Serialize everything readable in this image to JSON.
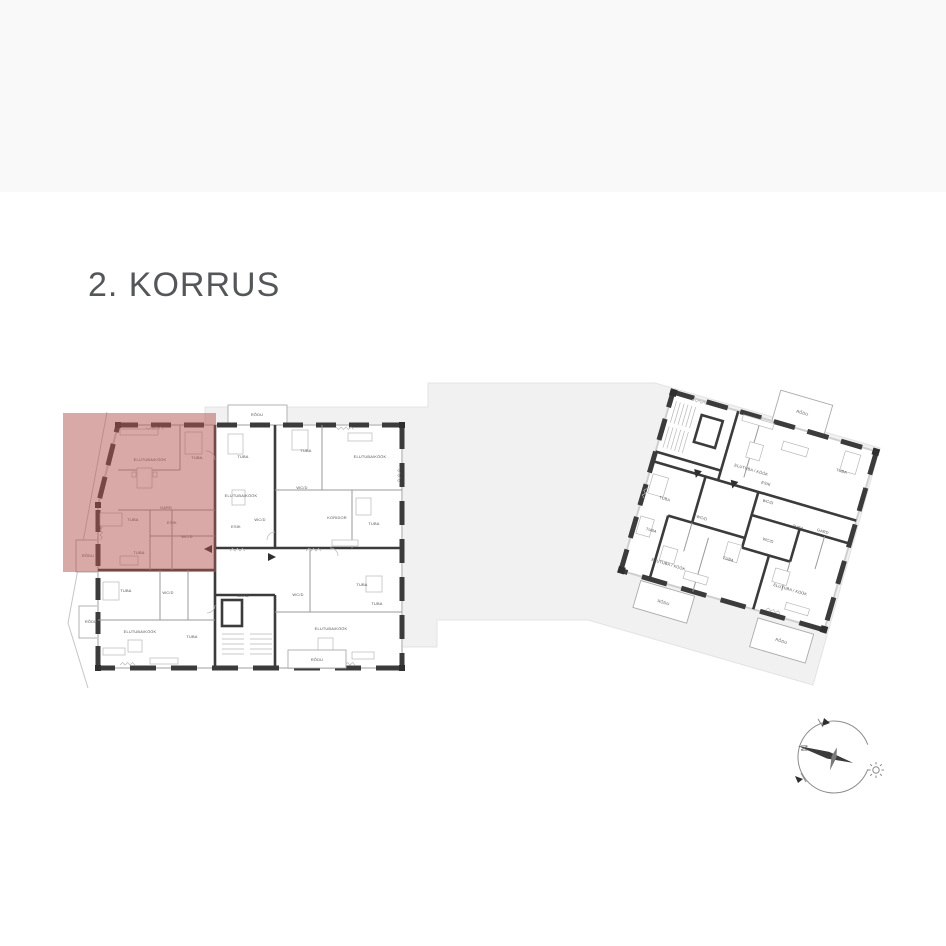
{
  "page": {
    "title": "2. KORRUS"
  },
  "colors": {
    "highlight": "rgba(177,83,77,0.5)",
    "wall": "#3b3b3c",
    "site_area": "#f1f1f2",
    "header_band": "#f9f9f9"
  },
  "compass": {
    "north_label": "N",
    "icons": [
      "compass-rose-icon",
      "sun-icon"
    ]
  },
  "plans": {
    "left": {
      "name": "building-a-floor-plan",
      "highlighted_apartment": true,
      "labels": [
        {
          "t": "RÕDU",
          "x": 257,
          "y": 416
        },
        {
          "t": "ELUTUBA/KÖÖK",
          "x": 150,
          "y": 461
        },
        {
          "t": "TUBA",
          "x": 197,
          "y": 459
        },
        {
          "t": "GARD",
          "x": 166,
          "y": 509
        },
        {
          "t": "TUBA",
          "x": 133,
          "y": 521
        },
        {
          "t": "ESIK",
          "x": 172,
          "y": 524
        },
        {
          "t": "WC/D",
          "x": 187,
          "y": 538
        },
        {
          "t": "TUBA",
          "x": 139,
          "y": 554
        },
        {
          "t": "RÕDU",
          "x": 88,
          "y": 557
        },
        {
          "t": "RÕDU",
          "x": 91,
          "y": 623
        },
        {
          "t": "TUBA",
          "x": 243,
          "y": 458
        },
        {
          "t": "ELUTUBA/KÖÖK",
          "x": 241,
          "y": 497
        },
        {
          "t": "ESIK",
          "x": 236,
          "y": 528
        },
        {
          "t": "WC/D",
          "x": 260,
          "y": 521
        },
        {
          "t": "TUBA",
          "x": 306,
          "y": 452
        },
        {
          "t": "ELUTUBA/KÖÖK",
          "x": 370,
          "y": 458
        },
        {
          "t": "WC/D",
          "x": 302,
          "y": 489
        },
        {
          "t": "KORIDOR",
          "x": 337,
          "y": 519
        },
        {
          "t": "TUBA",
          "x": 374,
          "y": 525
        },
        {
          "t": "TUBA",
          "x": 126,
          "y": 592
        },
        {
          "t": "WC/D",
          "x": 168,
          "y": 594
        },
        {
          "t": "ELUTUBA/KÖÖK",
          "x": 140,
          "y": 633
        },
        {
          "t": "TUBA",
          "x": 192,
          "y": 638
        },
        {
          "t": "GARD",
          "x": 243,
          "y": 597
        },
        {
          "t": "WC/D",
          "x": 298,
          "y": 596
        },
        {
          "t": "TUBA",
          "x": 362,
          "y": 586
        },
        {
          "t": "ELUTUBA/KÖÖK",
          "x": 331,
          "y": 630
        },
        {
          "t": "TUBA",
          "x": 377,
          "y": 605
        },
        {
          "t": "RÕDU",
          "x": 317,
          "y": 661
        }
      ]
    },
    "right": {
      "name": "building-b-floor-plan",
      "rotation_deg": 16.3,
      "labels": [
        {
          "t": "RÕDU",
          "x": 130,
          "y": -15
        },
        {
          "t": "ELUTUBA / KÖÖK",
          "x": 97,
          "y": 54
        },
        {
          "t": "TUBA",
          "x": 184,
          "y": 30
        },
        {
          "t": "ESIK",
          "x": 115,
          "y": 63
        },
        {
          "t": "WC/D",
          "x": 122,
          "y": 80
        },
        {
          "t": "TUBA",
          "x": 22,
          "y": 106
        },
        {
          "t": "WC/D",
          "x": 63,
          "y": 114
        },
        {
          "t": "TUBA",
          "x": 158,
          "y": 96
        },
        {
          "t": "GARD",
          "x": 183,
          "y": 93
        },
        {
          "t": "WC/D",
          "x": 133,
          "y": 117
        },
        {
          "t": "TUBA",
          "x": 18,
          "y": 140
        },
        {
          "t": "ELUTUBA / KÖÖK",
          "x": 44,
          "y": 168
        },
        {
          "t": "TUBA",
          "x": 100,
          "y": 146
        },
        {
          "t": "ELUTUBA / KÖÖK",
          "x": 168,
          "y": 158
        },
        {
          "t": "RÕDU",
          "x": 50,
          "y": 206
        },
        {
          "t": "RÕDU",
          "x": 174,
          "y": 210
        }
      ]
    }
  }
}
